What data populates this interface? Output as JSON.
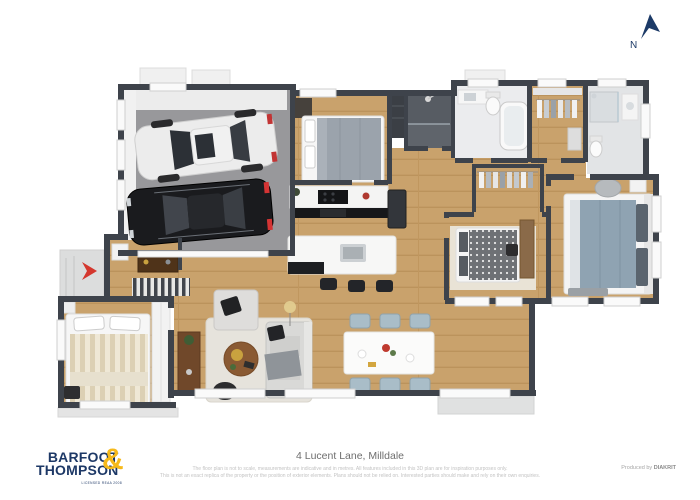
{
  "canvas": {
    "width": 700,
    "height": 500,
    "background": "#ffffff"
  },
  "compass": {
    "label": "N",
    "color": "#1c3a67"
  },
  "footer": {
    "address": "4 Lucent Lane, Milldale",
    "disclaimer_line1": "The floor plan is not to scale, measurements are indicative and in metres. All features included in this 3D plan are for inspiration purposes only.",
    "disclaimer_line2": "This is not an exact replica of the property or the position of exterior elements. Plans should not be relied on. Interested parties should make and rely on their own enquiries.",
    "produced_by_label": "Produced by",
    "producer_name": "DIAKRIT"
  },
  "brand": {
    "word1": "BARFOOT",
    "ampersand": "&",
    "word2": "THOMPSON",
    "tagline": "LICENSED REAA 2008",
    "navy": "#1d3866",
    "gold": "#f6b91a"
  },
  "floor_plan": {
    "colors": {
      "wall": "#3e434b",
      "wood_floor": "#c9a26c",
      "garage_floor": "#98989b",
      "tile_dark": "#5f646b",
      "tile_light": "#ebecee",
      "entry_arrow_red": "#d4372e"
    },
    "rooms": [
      {
        "name": "garage",
        "furniture": [
          "white-car",
          "black-car"
        ]
      },
      {
        "name": "bedroom-2",
        "furniture": [
          "double-bed",
          "dresser"
        ]
      },
      {
        "name": "bathroom",
        "furniture": [
          "shower",
          "linen-cupboard"
        ]
      },
      {
        "name": "main-bathroom",
        "furniture": [
          "vanity",
          "toilet",
          "bathtub"
        ]
      },
      {
        "name": "walk-in-wardrobe",
        "furniture": [
          "hanging-clothes",
          "shelves"
        ]
      },
      {
        "name": "ensuite",
        "furniture": [
          "shower",
          "toilet",
          "vanity"
        ]
      },
      {
        "name": "bedroom-3",
        "furniture": [
          "bed",
          "desk",
          "wardrobe",
          "rug"
        ]
      },
      {
        "name": "master-bedroom",
        "furniture": [
          "king-bed",
          "nightstand",
          "armchair",
          "bench"
        ]
      },
      {
        "name": "kitchen",
        "furniture": [
          "bench-with-cooktop",
          "fridge",
          "island-with-sink",
          "bar-stools"
        ]
      },
      {
        "name": "dining",
        "furniture": [
          "dining-table",
          "six-chairs"
        ]
      },
      {
        "name": "living",
        "furniture": [
          "sofa",
          "armchair",
          "coffee-table",
          "rug",
          "ottoman",
          "sideboard",
          "floor-lamp"
        ]
      },
      {
        "name": "entry",
        "furniture": [
          "console-table",
          "striped-runner-rug"
        ]
      },
      {
        "name": "bedroom-1",
        "furniture": [
          "double-bed",
          "wardrobe",
          "chair"
        ]
      },
      {
        "name": "laundry",
        "furniture": [
          "appliance"
        ]
      }
    ]
  }
}
